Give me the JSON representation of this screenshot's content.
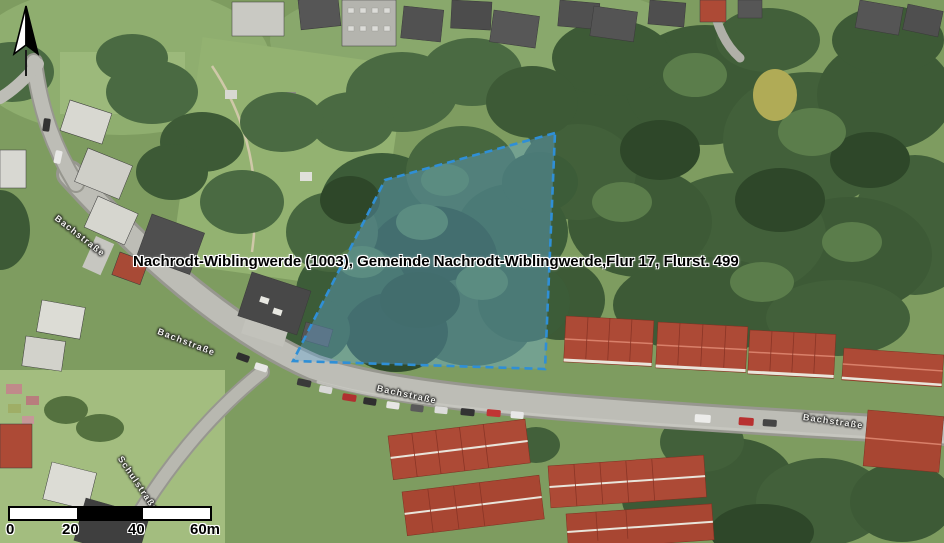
{
  "map": {
    "parcel": {
      "label": "Nachrodt-Wiblingwerde (1003), Gemeinde Nachrodt-Wiblingwerde,Flur 17, Flurst. 499",
      "outline_color": "#2f8fd6",
      "fill_color": "rgba(100,170,220,0.38)"
    },
    "streets": {
      "bachstrasse": "Bachstraße",
      "side_street": "Schulstraße"
    },
    "scalebar": {
      "ticks": [
        "0",
        "20",
        "40",
        "60m"
      ]
    },
    "north": {
      "icon": "north-arrow"
    }
  }
}
